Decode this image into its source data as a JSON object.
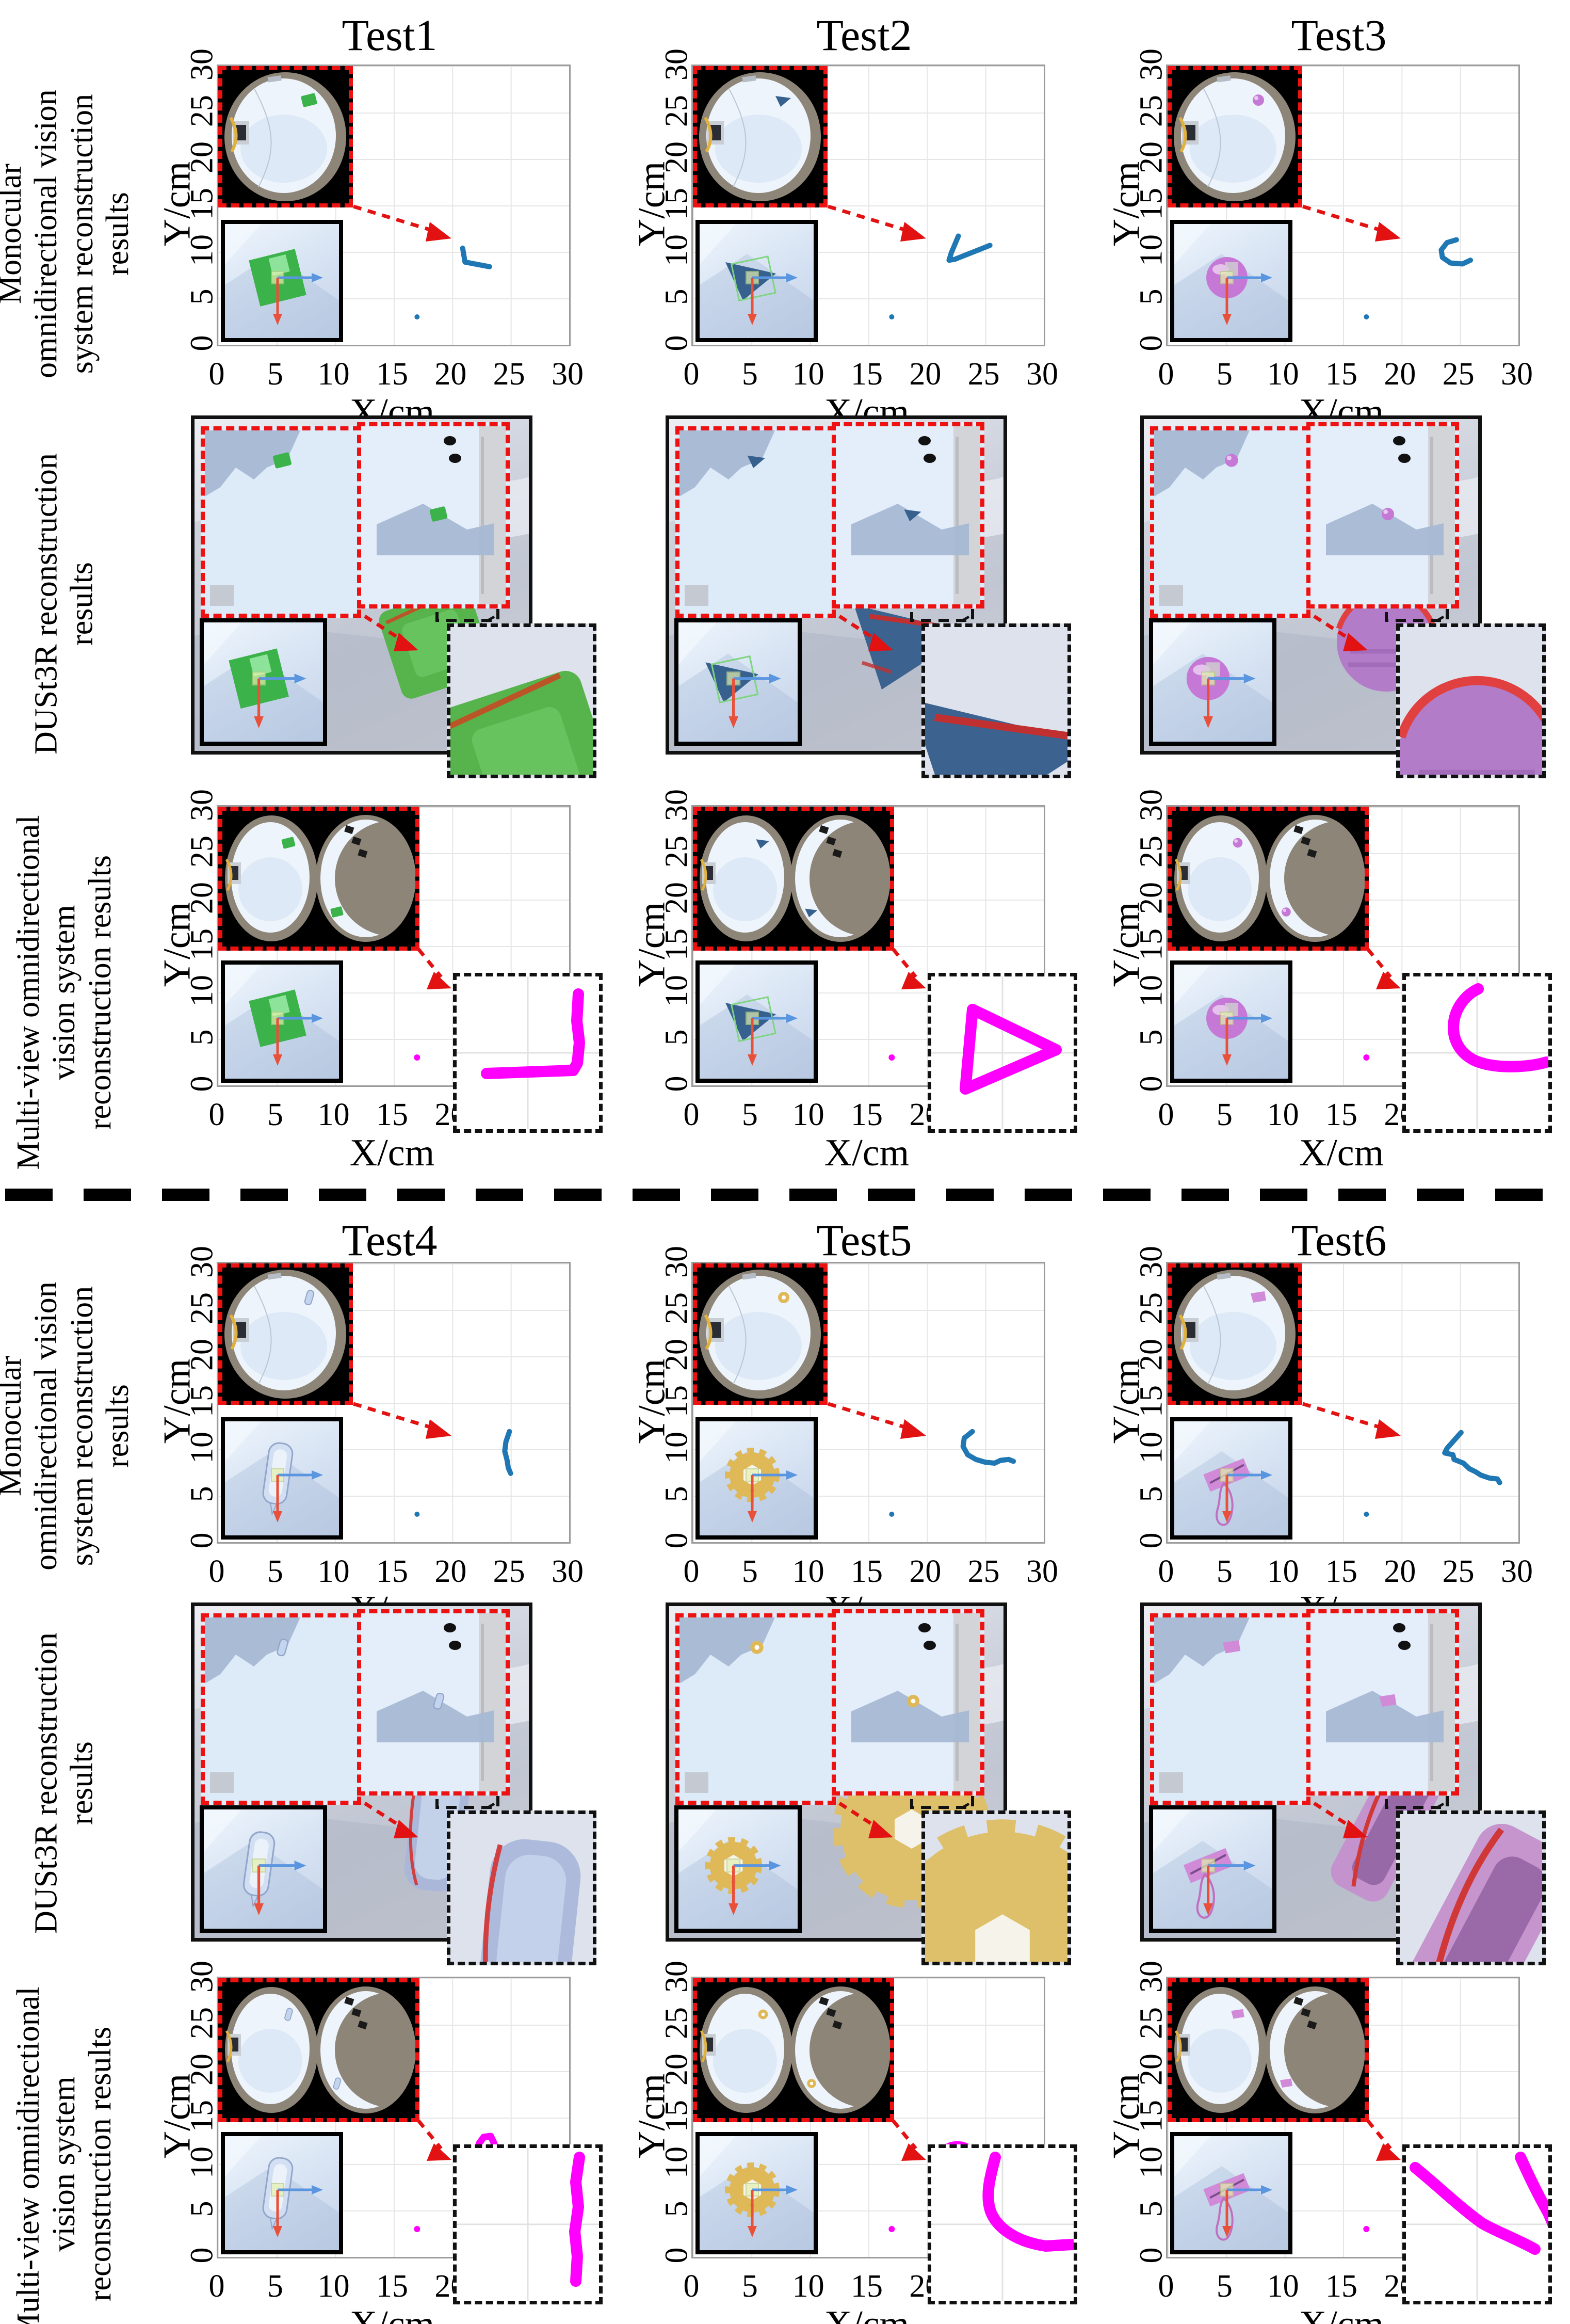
{
  "axis": {
    "xlabel": "X/cm",
    "ylabel": "Y/cm",
    "ticks": [
      0,
      5,
      10,
      15,
      20,
      25,
      30
    ],
    "range_cm": [
      0,
      30
    ],
    "grid": true
  },
  "row_labels": {
    "monocular": "Monocular omnidirectional vision system reconstruction results",
    "dust3r": "DUSt3R reconstruction results",
    "multiview": "Multi-view omnidirectional vision system reconstruction results"
  },
  "groups": [
    {
      "titles": [
        "Test1",
        "Test2",
        "Test3"
      ]
    },
    {
      "titles": [
        "Test4",
        "Test5",
        "Test6"
      ]
    }
  ],
  "colors": {
    "monocular_trajectory": "#1f77b4",
    "multiview_trajectory": "#ff00ff",
    "inset_border": "#ee1111",
    "arrow_red": "#e21212",
    "fisheye_rim": "#8d8577",
    "fisheye_glass": "#eef4fb",
    "scene_silhouette": "#a7b8d4",
    "grid_line": "#e6e6e6",
    "plot_border": "#9b9b9b"
  },
  "tests": [
    {
      "id": "Test1",
      "object": {
        "type": "cube",
        "label": "green cube",
        "color": "#3cb24a",
        "edge": "#2e8f3c"
      },
      "mono_trajectory_cm": [
        [
          20.9,
          10.4
        ],
        [
          21.1,
          8.9
        ],
        [
          23.2,
          8.4
        ]
      ],
      "multi_trajectory_cm": {
        "shape": "polygon",
        "points": [
          [
            21.4,
            10.1
          ],
          [
            22.9,
            10.4
          ],
          [
            23.1,
            8.9
          ],
          [
            21.7,
            8.6
          ]
        ]
      },
      "zoom_rect_cm": [
        21.9,
        7.9,
        1.6,
        1.6
      ],
      "stray_point_cm": [
        17,
        3
      ]
    },
    {
      "id": "Test2",
      "object": {
        "type": "triangle",
        "label": "blue triangle",
        "color": "#36618e",
        "edge": "#24496e"
      },
      "mono_trajectory_cm": [
        [
          22.7,
          11.7
        ],
        [
          22.1,
          9.9
        ],
        [
          21.9,
          9.1
        ],
        [
          22.4,
          9.2
        ],
        [
          25.4,
          10.7
        ]
      ],
      "multi_trajectory_cm": {
        "shape": "polygon",
        "points": [
          [
            21.1,
            10.9
          ],
          [
            23.3,
            10.0
          ],
          [
            21.1,
            8.8
          ]
        ]
      },
      "zoom_rect_cm": [
        21.8,
        9.3,
        1.5,
        1.5
      ],
      "stray_point_cm": [
        17,
        3
      ]
    },
    {
      "id": "Test3",
      "object": {
        "type": "sphere",
        "label": "purple sphere",
        "color": "#c678d6",
        "edge": "#9a54ac"
      },
      "mono_trajectory_cm": [
        [
          24.7,
          11.3
        ],
        [
          23.9,
          11.0
        ],
        [
          23.4,
          10.2
        ],
        [
          23.5,
          9.4
        ],
        [
          24.2,
          8.8
        ],
        [
          25.2,
          8.7
        ],
        [
          25.9,
          9.1
        ]
      ],
      "multi_trajectory_cm": {
        "shape": "circle",
        "center": [
          23.4,
          10.3
        ],
        "r": 0.55
      },
      "zoom_rect_cm": [
        22.9,
        9.7,
        1.1,
        1.1
      ],
      "stray_point_cm": [
        17,
        3
      ]
    },
    {
      "id": "Test4",
      "object": {
        "type": "bottle",
        "label": "transparent bottle",
        "color": "#c3d4ee",
        "edge": "#8fa4c8"
      },
      "mono_trajectory_cm": [
        [
          24.9,
          11.9
        ],
        [
          24.6,
          10.8
        ],
        [
          24.5,
          9.8
        ],
        [
          24.7,
          8.8
        ],
        [
          24.8,
          8.0
        ],
        [
          25.0,
          7.4
        ]
      ],
      "multi_trajectory_cm": {
        "shape": "polygon",
        "points": [
          [
            22.7,
            12.9
          ],
          [
            23.3,
            13.0
          ],
          [
            23.6,
            12.2
          ],
          [
            23.4,
            10.6
          ],
          [
            23.1,
            9.2
          ],
          [
            22.5,
            8.4
          ],
          [
            22.1,
            9.0
          ],
          [
            22.1,
            10.8
          ],
          [
            22.3,
            12.2
          ]
        ]
      },
      "zoom_rect_cm": [
        21.5,
        9.3,
        1.1,
        1.5
      ],
      "stray_point_cm": [
        17,
        3
      ]
    },
    {
      "id": "Test5",
      "object": {
        "type": "gear",
        "label": "yellow gear",
        "color": "#dfb957",
        "edge": "#b8923a"
      },
      "mono_trajectory_cm": [
        [
          23.9,
          11.9
        ],
        [
          23.2,
          11.2
        ],
        [
          23.1,
          10.3
        ],
        [
          23.5,
          9.4
        ],
        [
          24.2,
          8.9
        ],
        [
          25.0,
          8.6
        ],
        [
          25.8,
          8.5
        ],
        [
          26.3,
          8.8
        ],
        [
          27.0,
          8.9
        ],
        [
          27.4,
          8.7
        ]
      ],
      "multi_trajectory_cm": {
        "shape": "circle",
        "center": [
          22.6,
          10.6
        ],
        "r": 1.5
      },
      "zoom_rect_cm": [
        21.1,
        9.0,
        1.9,
        1.7
      ],
      "stray_point_cm": [
        17,
        3
      ]
    },
    {
      "id": "Test6",
      "object": {
        "type": "clamp",
        "label": "pink clamp",
        "color": "#d08ad8",
        "edge": "#a45cae"
      },
      "mono_trajectory_cm": [
        [
          25.1,
          11.8
        ],
        [
          23.9,
          10.1
        ],
        [
          23.7,
          9.6
        ],
        [
          24.4,
          9.4
        ],
        [
          24.5,
          8.9
        ],
        [
          25.3,
          8.5
        ],
        [
          25.8,
          7.9
        ],
        [
          26.3,
          7.6
        ],
        [
          26.8,
          7.2
        ],
        [
          27.5,
          6.9
        ],
        [
          28.2,
          6.8
        ],
        [
          28.4,
          6.4
        ]
      ],
      "multi_trajectory_cm": {
        "shape": "polygon",
        "points": [
          [
            23.7,
            10.3
          ],
          [
            24.6,
            11.0
          ],
          [
            25.1,
            10.6
          ],
          [
            25.4,
            9.8
          ],
          [
            25.9,
            9.1
          ],
          [
            26.4,
            8.5
          ],
          [
            26.9,
            7.8
          ],
          [
            27.4,
            7.0
          ],
          [
            27.7,
            6.3
          ],
          [
            27.0,
            6.1
          ],
          [
            26.4,
            6.7
          ],
          [
            25.7,
            7.4
          ],
          [
            25.0,
            8.1
          ],
          [
            24.4,
            8.7
          ],
          [
            23.8,
            9.3
          ],
          [
            23.4,
            9.9
          ]
        ]
      },
      "zoom_rect_cm": [
        25.2,
        6.8,
        2.0,
        1.8
      ],
      "stray_point_cm": [
        17,
        3
      ]
    }
  ]
}
